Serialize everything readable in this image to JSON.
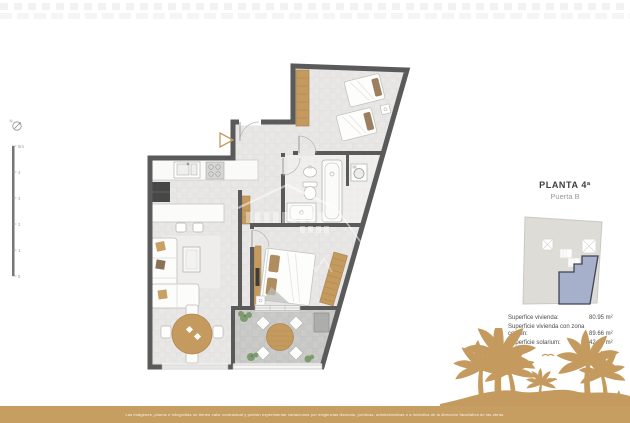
{
  "panel": {
    "title": "PLANTA 4ª",
    "subtitle": "Puerta B",
    "areas": [
      {
        "label": "Superfice vivienda:",
        "value": "80.95 m²"
      },
      {
        "label": "Superficie vivienda con zona comun:",
        "value": "89.66 m²"
      },
      {
        "label": "Superficie solarium:",
        "value": "42.10 m²"
      }
    ]
  },
  "scale_bar": {
    "top": "5m",
    "ticks": [
      "4",
      "3",
      "2",
      "1",
      "0"
    ]
  },
  "compass": {
    "label": "N"
  },
  "footer": {
    "disclaimer": "Las imágenes, planos e infografías no tienen valor contractual y podrán experimentar variaciones por exigencias técnicas, jurídicas, administrativas o a iniciativa de la dirección facultativa de las obras."
  },
  "colors": {
    "gold": "#c49a5f",
    "wall": "#5a5a5a",
    "unit_highlight": "#a6b0ca",
    "floor": "#e9e8e6",
    "terrace": "#cbcbc9"
  }
}
